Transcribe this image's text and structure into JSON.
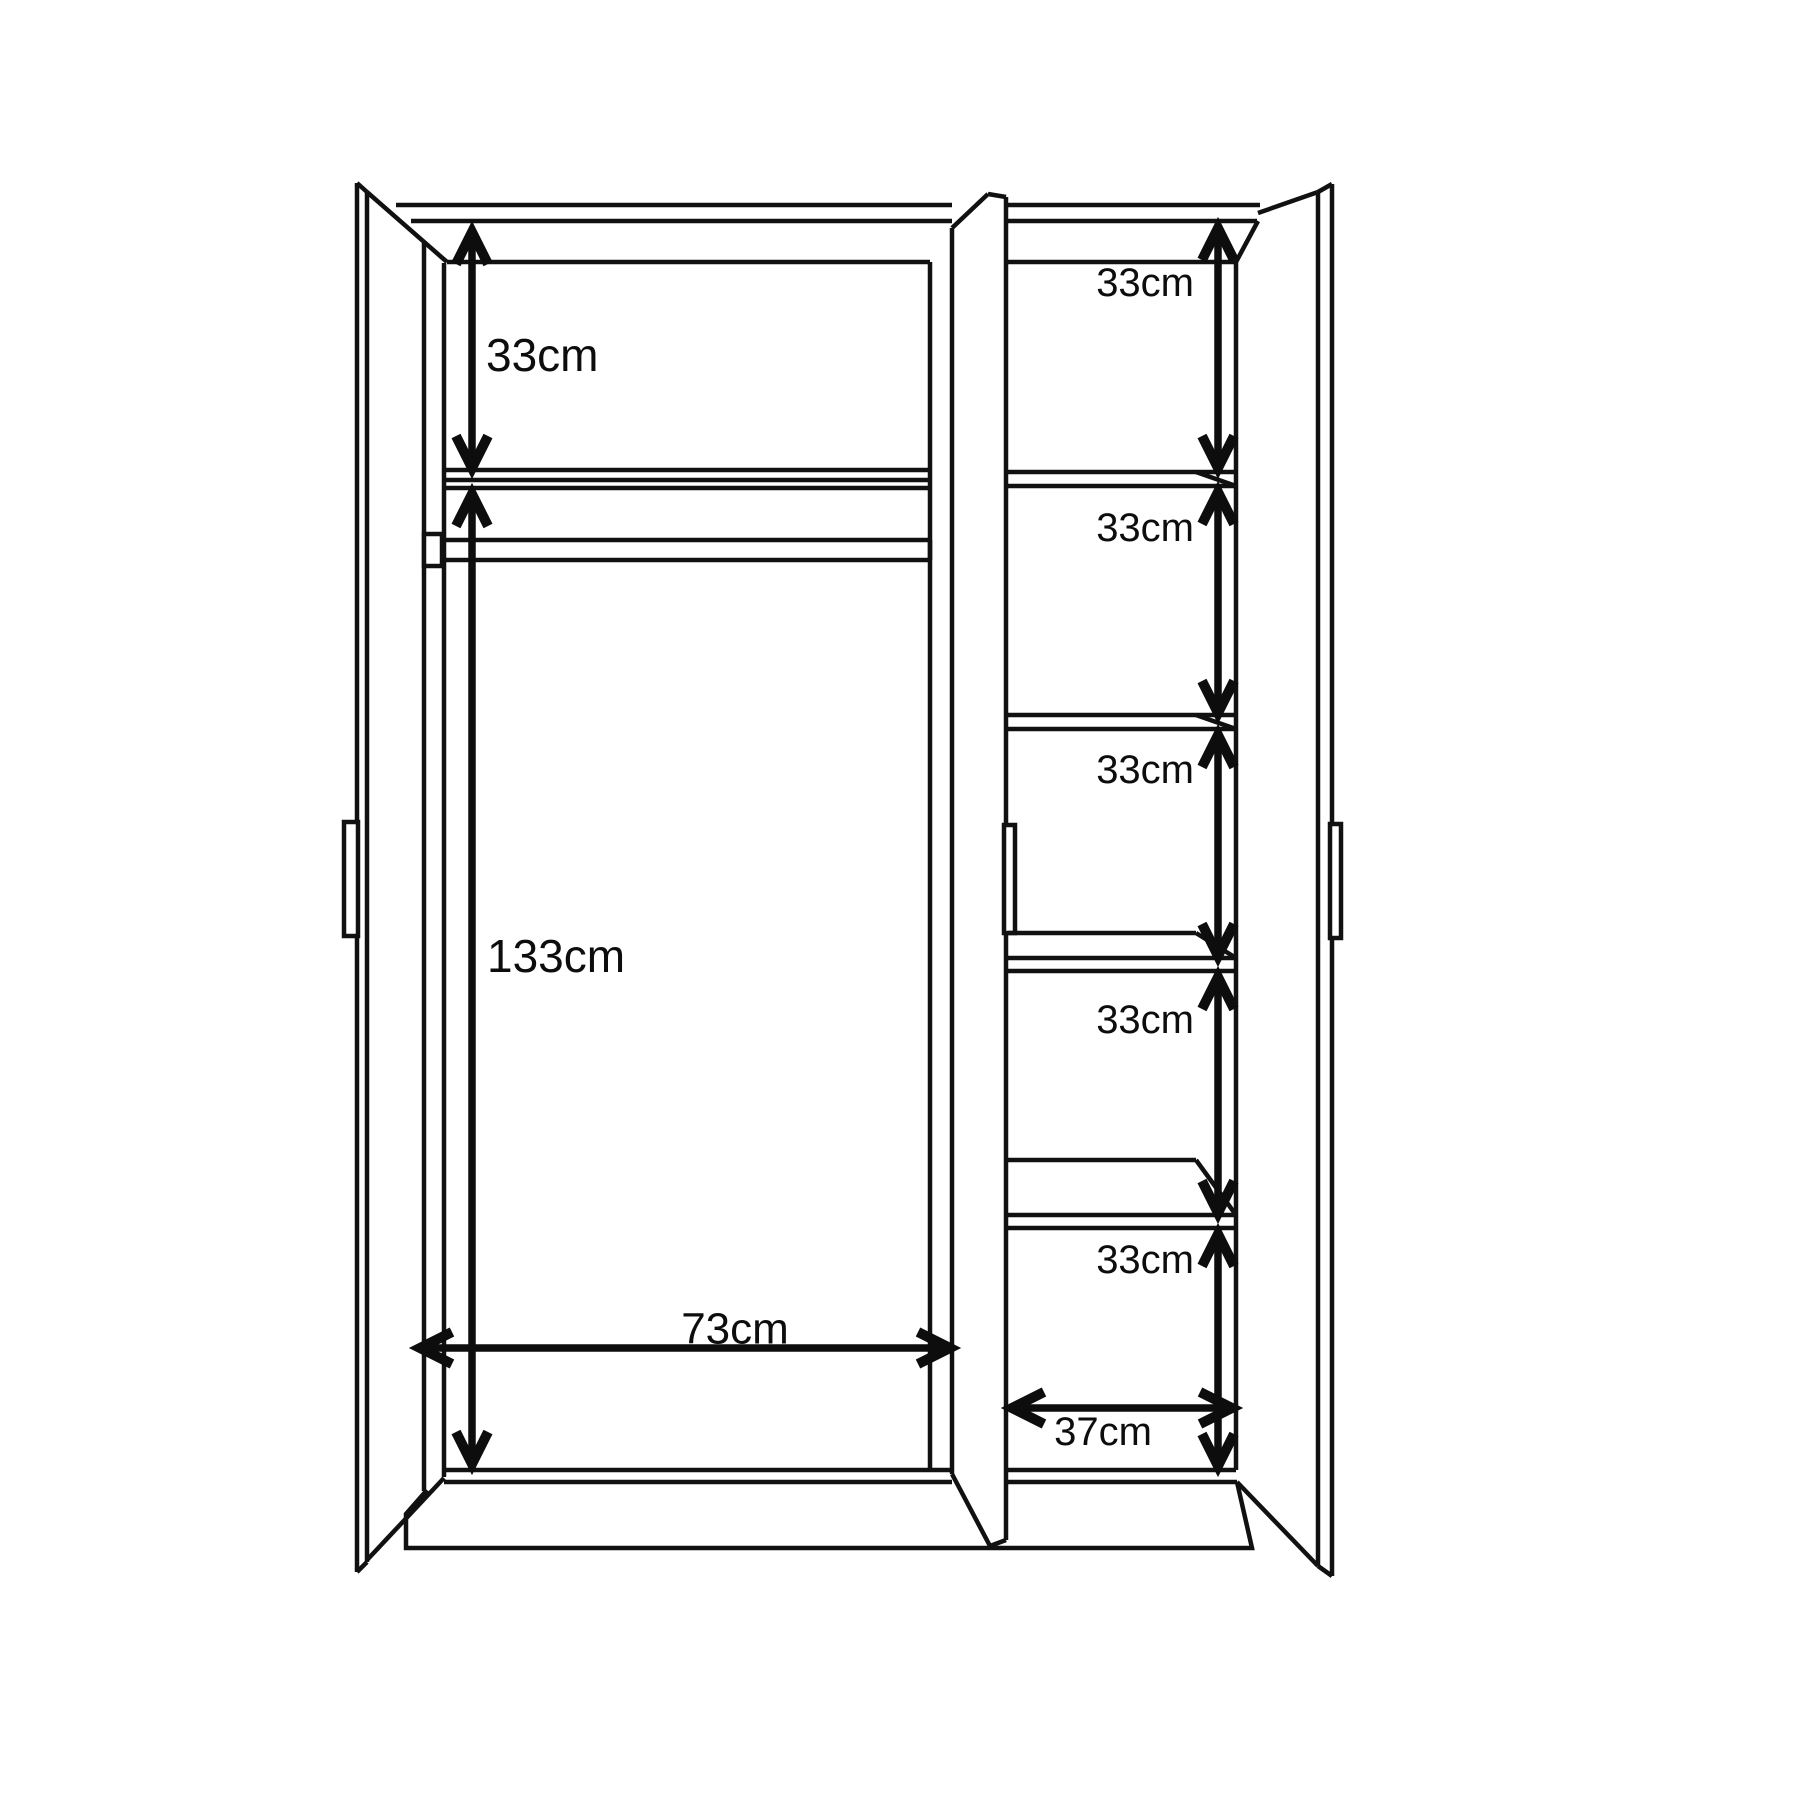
{
  "diagram": {
    "kind": "wardrobe-dimension-drawing",
    "unit": "cm",
    "colors": {
      "line": "#111111",
      "text": "#0d0d0d",
      "background": "#ffffff"
    },
    "dimensions": {
      "left": {
        "top_shelf_height": "33cm",
        "hanging_height": "133cm",
        "inner_width": "73cm"
      },
      "right": {
        "compartments": [
          "33cm",
          "33cm",
          "33cm",
          "33cm",
          "33cm"
        ],
        "inner_width": "37cm"
      }
    }
  }
}
